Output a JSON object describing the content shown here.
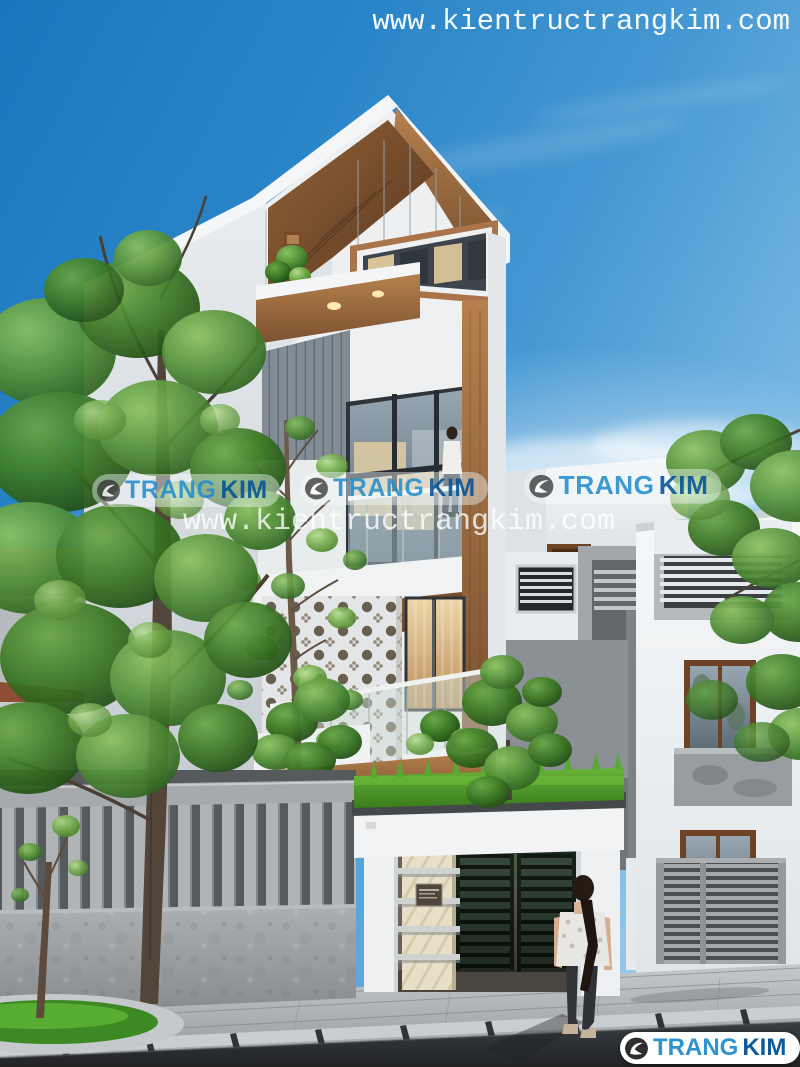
{
  "watermarks": {
    "top_url": "www.kientructrangkim.com",
    "center_url": "www.kientructrangkim.com",
    "logo": {
      "part1": "TRANG",
      "part2": "KIM"
    }
  },
  "colors": {
    "sky_top": "#1c76bd",
    "sky_horizon": "#c2e2f5",
    "brand_trang_blue": "#2f93cf",
    "brand_kim_blue": "#0f5a9c",
    "wood_accent": "#9c6b3f",
    "wall_white": "#f0f2f4",
    "grass_green": "#4f9e2d",
    "gate_green": "#36493c",
    "road_dark": "#26282a"
  }
}
